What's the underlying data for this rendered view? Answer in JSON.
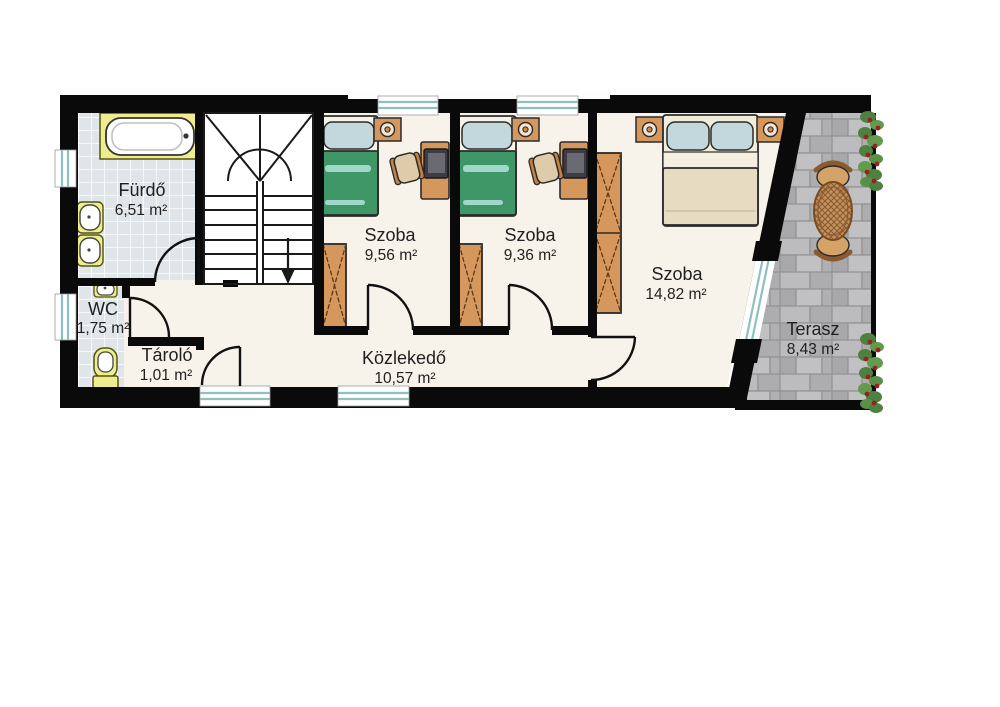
{
  "rooms": {
    "bathroom": {
      "name": "Fürdő",
      "area": "6,51 m²"
    },
    "wc": {
      "name": "WC",
      "area": "1,75 m²"
    },
    "storage": {
      "name": "Tároló",
      "area": "1,01 m²"
    },
    "hallway": {
      "name": "Közlekedő",
      "area": "10,57 m²"
    },
    "room1": {
      "name": "Szoba",
      "area": "9,56 m²"
    },
    "room2": {
      "name": "Szoba",
      "area": "9,36 m²"
    },
    "room3": {
      "name": "Szoba",
      "area": "14,82 m²"
    },
    "terrace": {
      "name": "Terasz",
      "area": "8,43 m²"
    }
  },
  "colors": {
    "wall": "#0a0a0a",
    "floor": "#f8f3ea",
    "tile": "#dfe5e9",
    "stone": "#b4b4b6",
    "window_glass": "#8fc0bf",
    "wood": "#d6975c",
    "bed_green": "#3f9767",
    "bed_stripe": "#9fd8c9",
    "pillow_blue": "#c2d8dc",
    "bed_cream": "#e6dcc2",
    "fixture_yellow": "#eeee8e",
    "vine_green": "#4e8040",
    "berry_red": "#9c2020",
    "text": "#1f1f1f"
  }
}
